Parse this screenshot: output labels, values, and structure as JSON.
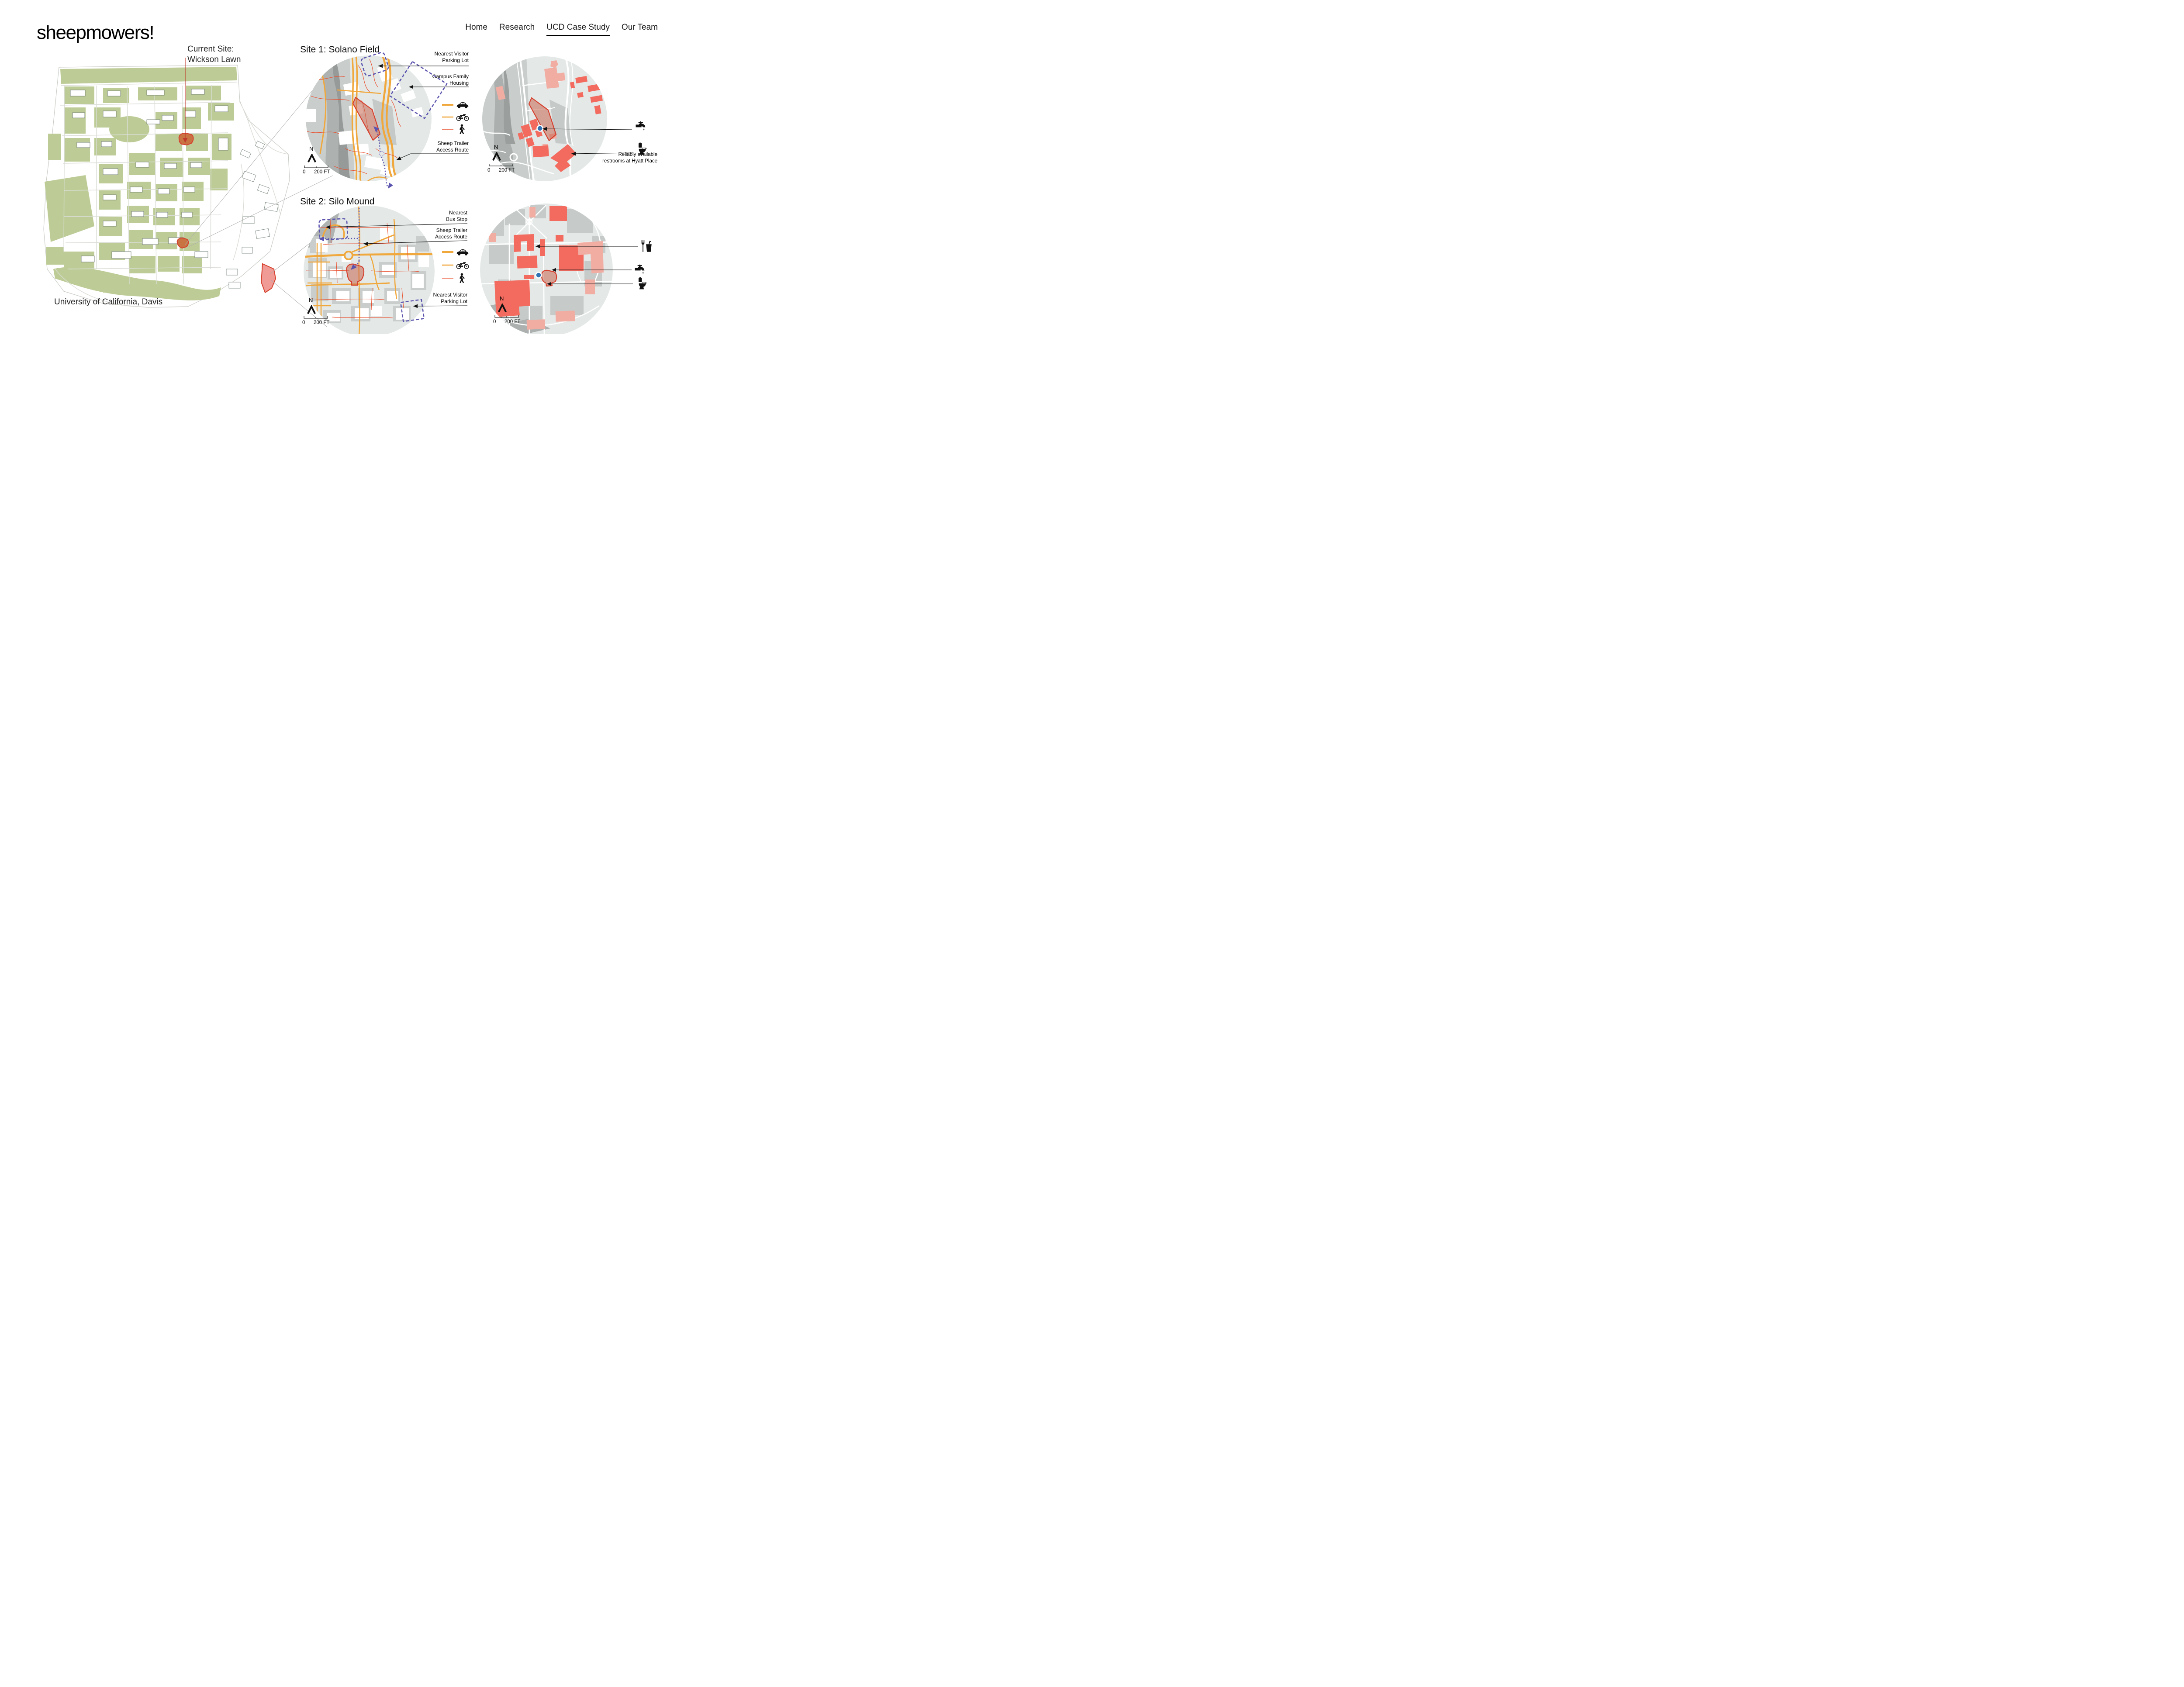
{
  "brand": {
    "logo": "sheepmowers!"
  },
  "nav": {
    "items": [
      {
        "label": "Home"
      },
      {
        "label": "Research"
      },
      {
        "label": "UCD Case Study",
        "active": true
      },
      {
        "label": "Our Team"
      }
    ]
  },
  "overview": {
    "current_site_label": "Current Site:\nWickson Lawn",
    "caption": "University of California, Davis"
  },
  "site1": {
    "title": "Site 1: Solano Field",
    "label_parking": "Nearest Visitor\nParking Lot",
    "label_housing": "Campus Family\nHousing",
    "label_trailer": "Sheep Trailer\nAccess Route",
    "compass": "N",
    "scale_zero": "0",
    "scale_label": "200 FT"
  },
  "site1_amenities": {
    "note_restrooms": "Reliably available\nrestrooms at Hyatt Place",
    "compass": "N",
    "scale_zero": "0",
    "scale_label": "200 FT"
  },
  "site2": {
    "title": "Site 2: Silo Mound",
    "label_bus": "Nearest\nBus Stop",
    "label_trailer": "Sheep Trailer\nAccess Route",
    "label_parking": "Nearest Visitor\nParking Lot",
    "compass": "N",
    "scale_zero": "0",
    "scale_label": "200 FT"
  },
  "site2_amenities": {
    "compass": "N",
    "scale_zero": "0",
    "scale_label": "200 FT"
  },
  "icons": {
    "legend": [
      "car-icon",
      "bicycle-icon",
      "pedestrian-icon"
    ],
    "amenities": [
      "food-drink-icon",
      "water-faucet-icon",
      "toilet-icon"
    ],
    "compass": "north-arrow-icon"
  },
  "colors": {
    "accent_red": "#D6402E",
    "campus_green": "#BDCC96",
    "road_orange": "#F0A73C",
    "path_red": "#E8502F",
    "route_purple": "#5B54AE",
    "map_bg": "#E4E9E8",
    "building_red": "#F26B5E",
    "building_pink": "#F2ADA3",
    "water_blue": "#3072B4",
    "ink": "#1A1A1A"
  }
}
